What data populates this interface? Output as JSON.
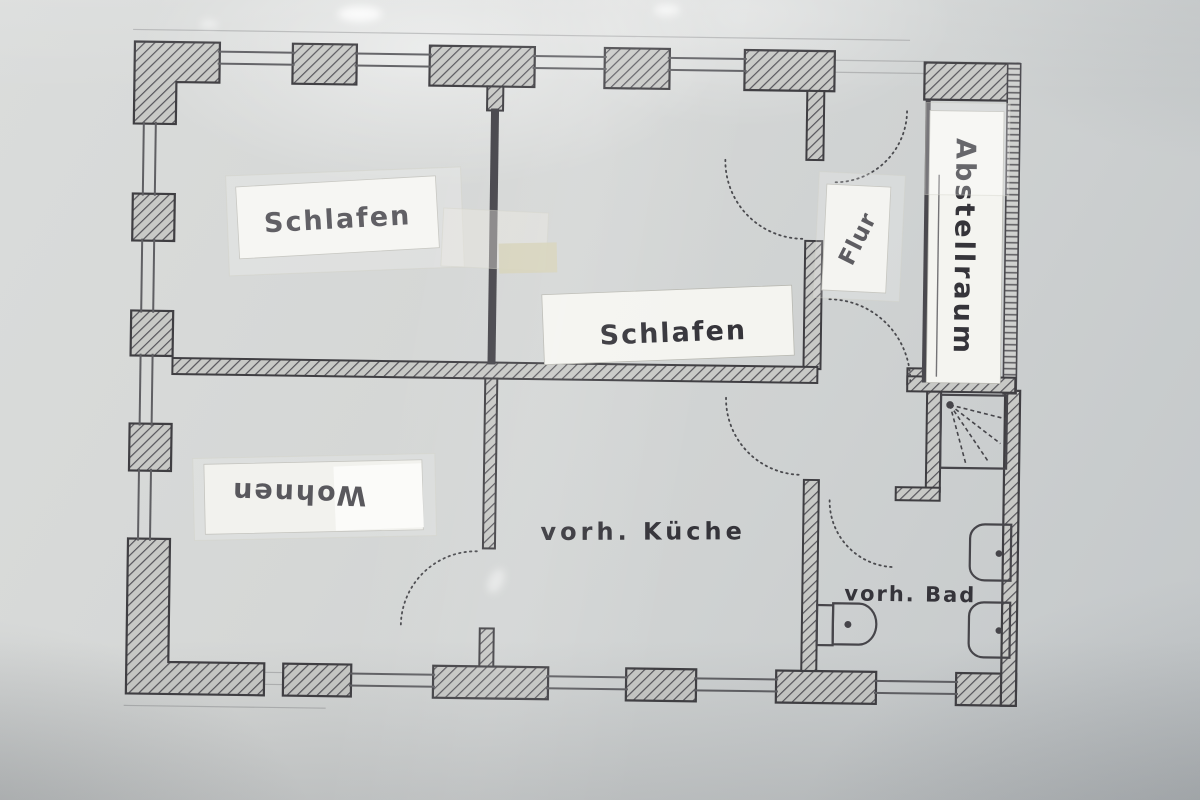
{
  "floor_plan": {
    "rooms": [
      {
        "id": "bedroom-1",
        "label": "Schlafen"
      },
      {
        "id": "bedroom-2",
        "label": "Schlafen"
      },
      {
        "id": "hallway",
        "label": "Flur"
      },
      {
        "id": "storage",
        "label": "Abstellraum"
      },
      {
        "id": "living",
        "label": "Wohnen"
      },
      {
        "id": "kitchen",
        "label": "vorh. Küche"
      },
      {
        "id": "bath",
        "label": "vorh. Bad"
      }
    ],
    "fixtures": [
      {
        "id": "shower",
        "icon": "shower-spray-icon"
      },
      {
        "id": "toilet",
        "icon": "toilet-icon"
      },
      {
        "id": "washbasin-1",
        "icon": "washbasin-icon"
      },
      {
        "id": "washbasin-2",
        "icon": "washbasin-icon"
      }
    ],
    "colors": {
      "paper": "#d4d6d5",
      "ink": "#3f3e42",
      "hatch": "#58575b",
      "label_paper": "#f4f4f0",
      "tape_beige": "#d6d2b8"
    }
  }
}
